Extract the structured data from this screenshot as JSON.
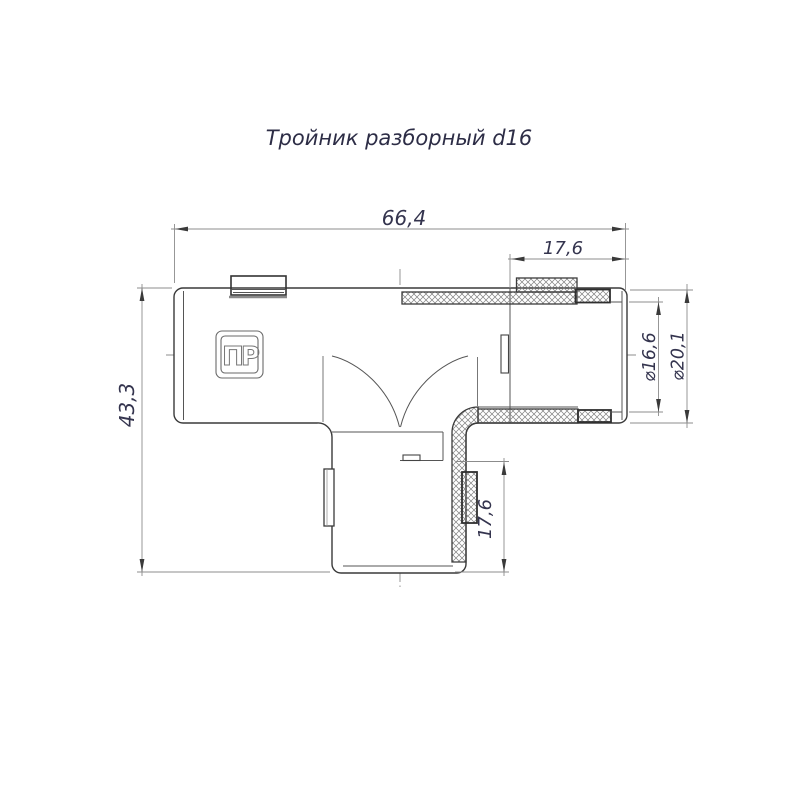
{
  "title": "Тройник разборный d16",
  "logo_text": "ПР",
  "dimensions": {
    "overall_width": "66,4",
    "top_nut_length": "17,6",
    "overall_height": "43,3",
    "bottom_nut_length": "17,6",
    "inner_diameter": "⌀16,6",
    "outer_diameter": "⌀20,1"
  },
  "colors": {
    "background": "#ffffff",
    "contour_line": "#3a3a3a",
    "thin_line": "#8c8c8c",
    "dimension_text": "#34344e"
  }
}
